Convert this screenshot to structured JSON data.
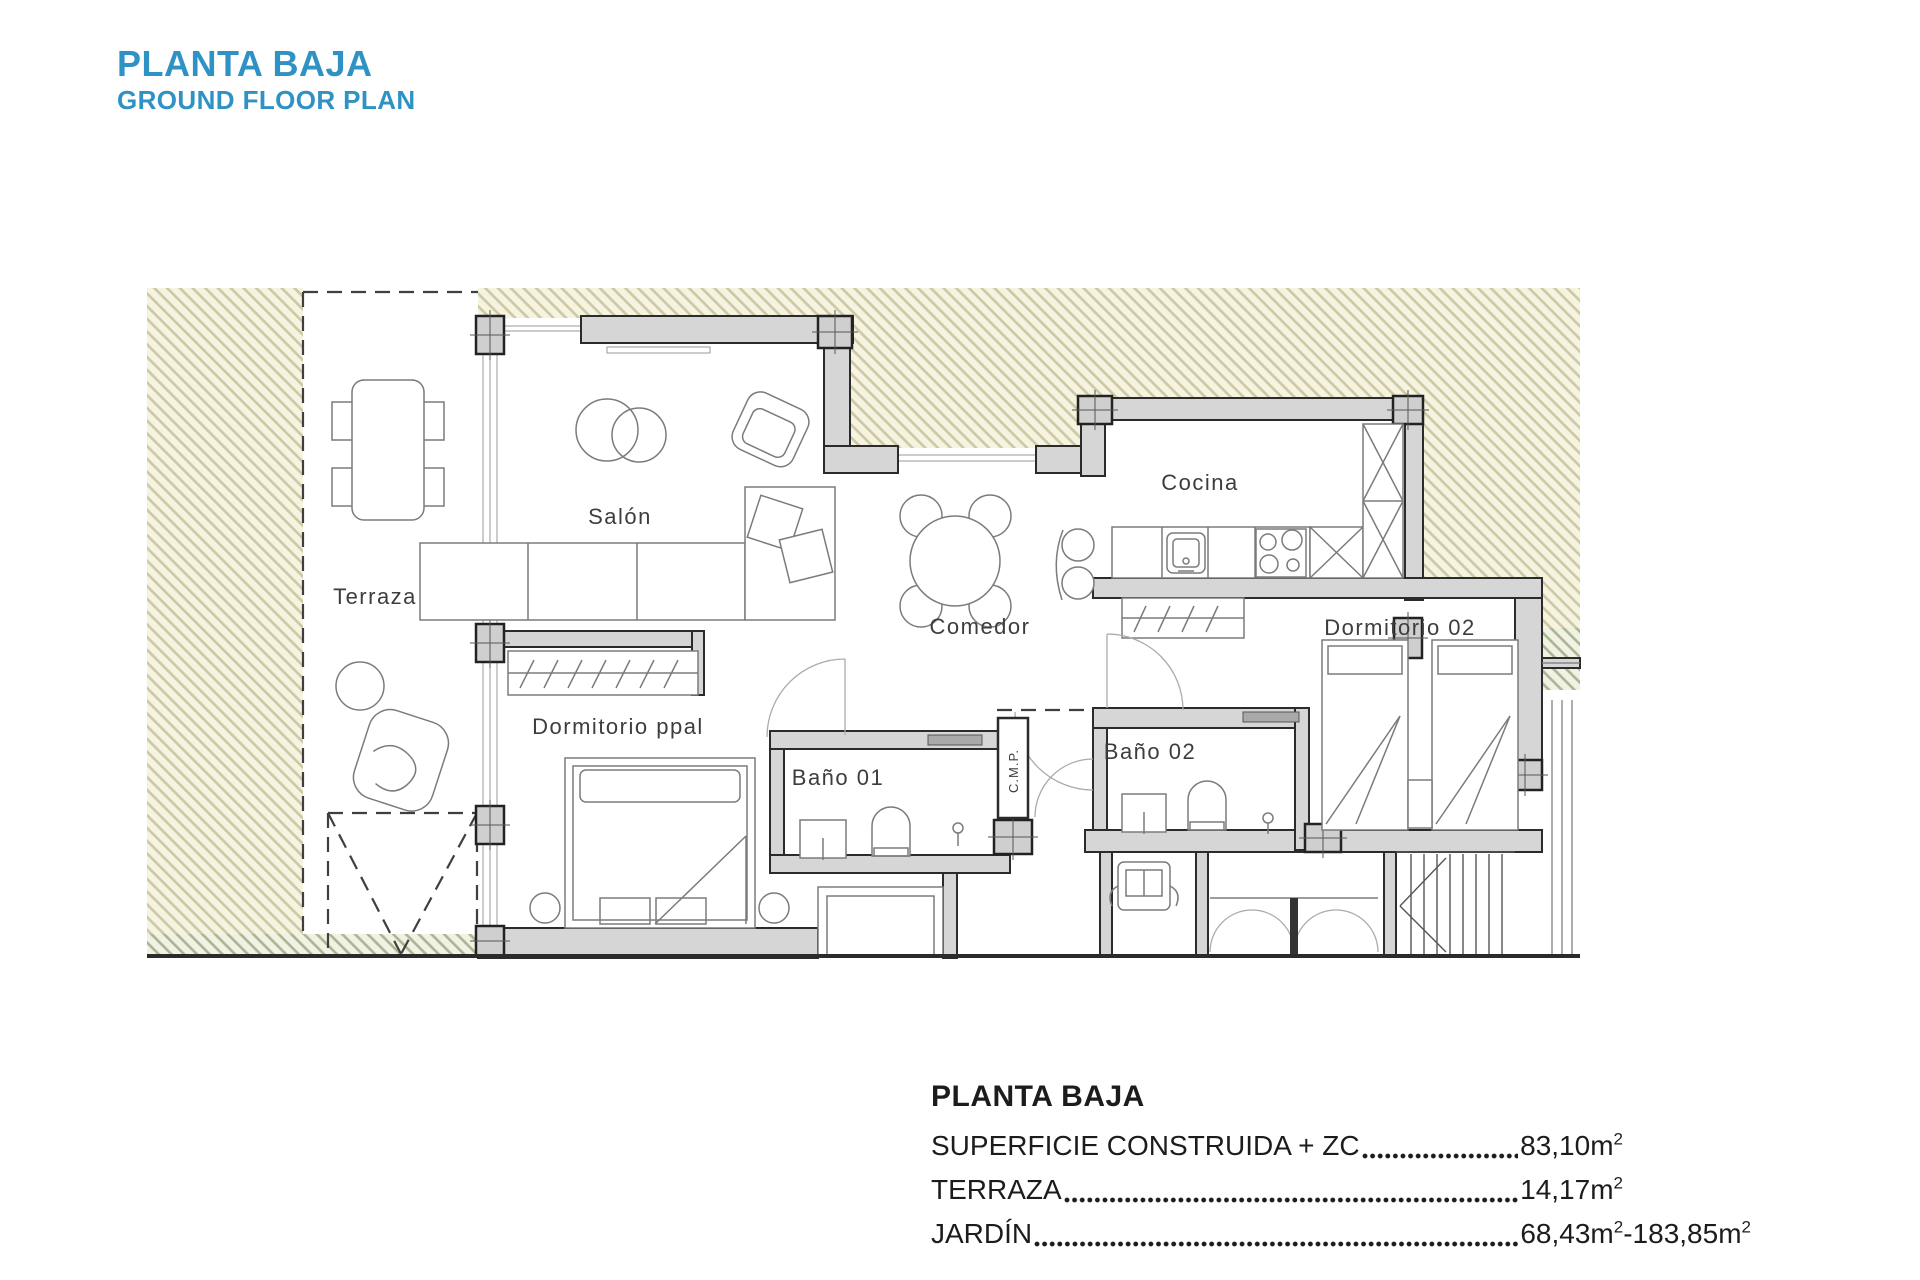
{
  "header": {
    "title": "PLANTA BAJA",
    "subtitle": "GROUND FLOOR PLAN"
  },
  "colors": {
    "accent_blue": "#2F92C5",
    "hatch_background": "#F6F3E0",
    "hatch_line_beige": "#CCC8A4",
    "hatch_line_green": "#A9B592",
    "wall_fill": "#D6D6D6",
    "wall_stroke": "#2B2B2B",
    "furniture_line": "#7B7B7B",
    "label_text": "#3D3D3D"
  },
  "plan": {
    "rooms": {
      "salon": {
        "label": "Salón"
      },
      "terraza": {
        "label": "Terraza"
      },
      "cocina": {
        "label": "Cocina"
      },
      "comedor": {
        "label": "Comedor"
      },
      "dormitorio_ppal": {
        "label": "Dormitorio ppal"
      },
      "bano_01": {
        "label": "Baño 01"
      },
      "bano_02": {
        "label": "Baño 02"
      },
      "dormitorio_02": {
        "label": "Dormitorio 02"
      }
    },
    "shaft_label": "C.M.P."
  },
  "summary": {
    "header": "PLANTA BAJA",
    "rows": {
      "construida": {
        "label": "SUPERFICIE CONSTRUIDA + ZC",
        "value": "83,10m",
        "sup": "2"
      },
      "terraza": {
        "label": "TERRAZA",
        "value": "14,17m",
        "sup": "2"
      },
      "jardin": {
        "label": "JARDÍN",
        "value": "68,43m",
        "sup": "2",
        "value2": "-183,85m",
        "sup2": "2"
      }
    }
  }
}
